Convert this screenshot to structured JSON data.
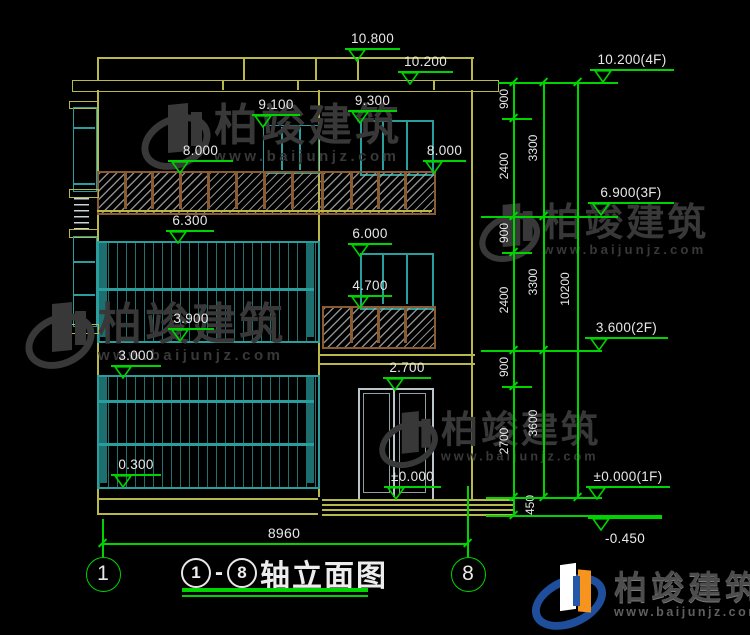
{
  "drawing": {
    "type": "architectural elevation (CAD)",
    "title_full": "①-⑧轴立面图",
    "title": {
      "axis_start": "1",
      "axis_end": "8",
      "text": "轴立面图"
    },
    "bottom_dimension": {
      "label": "8960",
      "y": 543,
      "x1": 102,
      "x2": 467,
      "label_x": 284,
      "label_y": 525
    },
    "axis_bubbles": [
      {
        "label": "1",
        "x": 102,
        "y": 573
      },
      {
        "label": "8",
        "x": 467,
        "y": 573
      }
    ]
  },
  "elevation_markers": [
    {
      "label": "10.800",
      "lx": 345,
      "rx": 400,
      "y": 48,
      "tip": 357
    },
    {
      "label": "10.200",
      "lx": 398,
      "rx": 453,
      "y": 71,
      "tip": 410
    },
    {
      "label": "9.100",
      "lx": 252,
      "rx": 300,
      "y": 114,
      "tip": 263
    },
    {
      "label": "9.300",
      "lx": 348,
      "rx": 397,
      "y": 110,
      "tip": 360
    },
    {
      "label": "8.000",
      "lx": 168,
      "rx": 233,
      "y": 160,
      "tip": 180
    },
    {
      "label": "8.000",
      "lx": 423,
      "rx": 466,
      "y": 160,
      "tip": 434
    },
    {
      "label": "6.300",
      "lx": 166,
      "rx": 214,
      "y": 230,
      "tip": 178
    },
    {
      "label": "6.000",
      "lx": 348,
      "rx": 392,
      "y": 243,
      "tip": 360
    },
    {
      "label": "4.700",
      "lx": 348,
      "rx": 392,
      "y": 295,
      "tip": 360
    },
    {
      "label": "3.900",
      "lx": 168,
      "rx": 214,
      "y": 328,
      "tip": 180
    },
    {
      "label": "3.000",
      "lx": 111,
      "rx": 161,
      "y": 365,
      "tip": 123
    },
    {
      "label": "2.700",
      "lx": 383,
      "rx": 431,
      "y": 377,
      "tip": 395
    },
    {
      "label": "0.300",
      "lx": 111,
      "rx": 161,
      "y": 474,
      "tip": 123
    },
    {
      "label": "±0.000",
      "lx": 384,
      "rx": 441,
      "y": 486,
      "tip": 396
    }
  ],
  "floor_markers": [
    {
      "label": "10.200(4F)",
      "lx": 590,
      "rx": 674,
      "y": 69,
      "tip": 603
    },
    {
      "label": "6.900(3F)",
      "lx": 588,
      "rx": 674,
      "y": 202,
      "tip": 601
    },
    {
      "label": "3.600(2F)",
      "lx": 585,
      "rx": 668,
      "y": 337,
      "tip": 599
    },
    {
      "label": "±0.000(1F)",
      "lx": 586,
      "rx": 670,
      "y": 486,
      "tip": 597
    },
    {
      "label": "-0.450",
      "lx": 588,
      "rx": 662,
      "y": 517,
      "tip": 601,
      "below": true
    }
  ],
  "dim_chains": [
    {
      "x": 513,
      "label_x": 504,
      "segments": [
        {
          "value": "900",
          "y1": 82,
          "y2": 118
        },
        {
          "value": "2400",
          "y1": 118,
          "y2": 216
        },
        {
          "value": "900",
          "y1": 216,
          "y2": 252
        },
        {
          "value": "2400",
          "y1": 252,
          "y2": 350
        },
        {
          "value": "900",
          "y1": 350,
          "y2": 386
        },
        {
          "value": "2700",
          "y1": 386,
          "y2": 497
        },
        {
          "value": "450",
          "y1": 497,
          "y2": 515,
          "lx": 530
        }
      ]
    },
    {
      "x": 543,
      "label_x": 533,
      "segments": [
        {
          "value": "3300",
          "y1": 82,
          "y2": 216
        },
        {
          "value": "3300",
          "y1": 216,
          "y2": 350
        },
        {
          "value": "3600",
          "y1": 350,
          "y2": 497
        }
      ]
    },
    {
      "x": 577,
      "label_x": 565,
      "segments": [
        {
          "value": "10200",
          "y1": 82,
          "y2": 497
        }
      ]
    }
  ],
  "level_lines": [
    {
      "x1": 498,
      "x2": 618,
      "y": 82
    },
    {
      "x1": 502,
      "x2": 532,
      "y": 118
    },
    {
      "x1": 481,
      "x2": 618,
      "y": 216
    },
    {
      "x1": 502,
      "x2": 532,
      "y": 252
    },
    {
      "x1": 481,
      "x2": 602,
      "y": 350
    },
    {
      "x1": 502,
      "x2": 532,
      "y": 386
    },
    {
      "x1": 486,
      "x2": 602,
      "y": 497
    },
    {
      "x1": 486,
      "x2": 662,
      "y": 515
    }
  ],
  "extension_lines": [
    {
      "x": 102,
      "y1": 519,
      "y2": 557
    },
    {
      "x": 467,
      "y1": 486,
      "y2": 557
    }
  ],
  "watermark": {
    "name": "柏竣建筑",
    "url": "www.baijunjz.com",
    "instances": [
      {
        "x": 140,
        "y": 104,
        "s": 1.0
      },
      {
        "x": 478,
        "y": 204,
        "s": 0.88
      },
      {
        "x": 24,
        "y": 303,
        "s": 1.0
      },
      {
        "x": 378,
        "y": 412,
        "s": 0.85
      }
    ]
  },
  "logo": {
    "name": "柏竣建筑",
    "url": "www.baijunjz.com"
  },
  "colors": {
    "background": "#000000",
    "dimension_green": "#00d400",
    "wall_yellow": "#b9b94a",
    "window_teal": "#2a9d9d",
    "railing_brown": "#8a5a30",
    "text_white": "#e8e8e8",
    "watermark_gray": "#383838",
    "logo_blue": "#1e4e9c",
    "logo_orange": "#f7941d"
  }
}
